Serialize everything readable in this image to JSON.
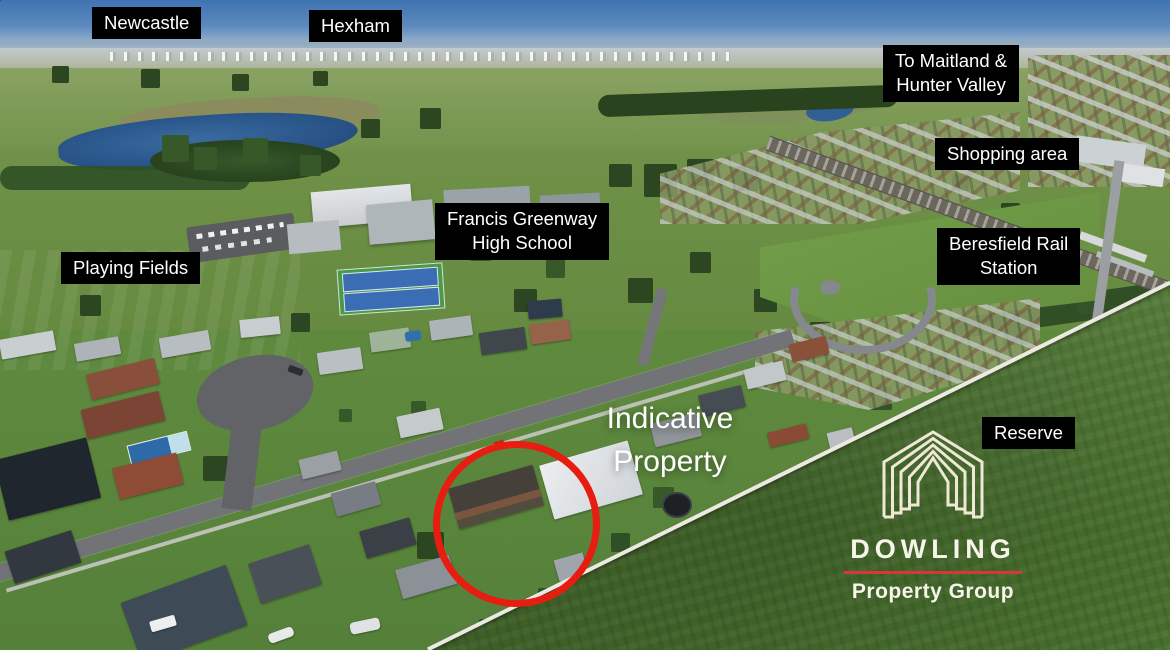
{
  "labels": {
    "newcastle": {
      "text": "Newcastle"
    },
    "hexham": {
      "text": "Hexham"
    },
    "maitland": {
      "line1": "To Maitland &",
      "line2": "Hunter Valley"
    },
    "shopping": {
      "text": "Shopping area"
    },
    "school": {
      "line1": "Francis Greenway",
      "line2": "High School"
    },
    "station": {
      "line1": "Beresfield Rail",
      "line2": "Station"
    },
    "playing_fields": {
      "text": "Playing Fields"
    },
    "reserve": {
      "text": "Reserve"
    },
    "indicative": {
      "line1": "Indicative",
      "line2": "Property"
    }
  },
  "logo": {
    "brand": "DOWLING",
    "tagline": "Property Group",
    "icon": "dowling-house-icon",
    "accent_color": "#d9363a",
    "text_color": "#f7f4ea"
  },
  "marker": {
    "shape": "ellipse",
    "color": "#e71d12"
  },
  "colors": {
    "label_bg": "#000000",
    "label_text": "#ffffff",
    "sky_blue": "#3e73b2",
    "field_green": "#6f9148",
    "reserve_green": "#4c7630",
    "lake_blue": "#2a568a"
  }
}
